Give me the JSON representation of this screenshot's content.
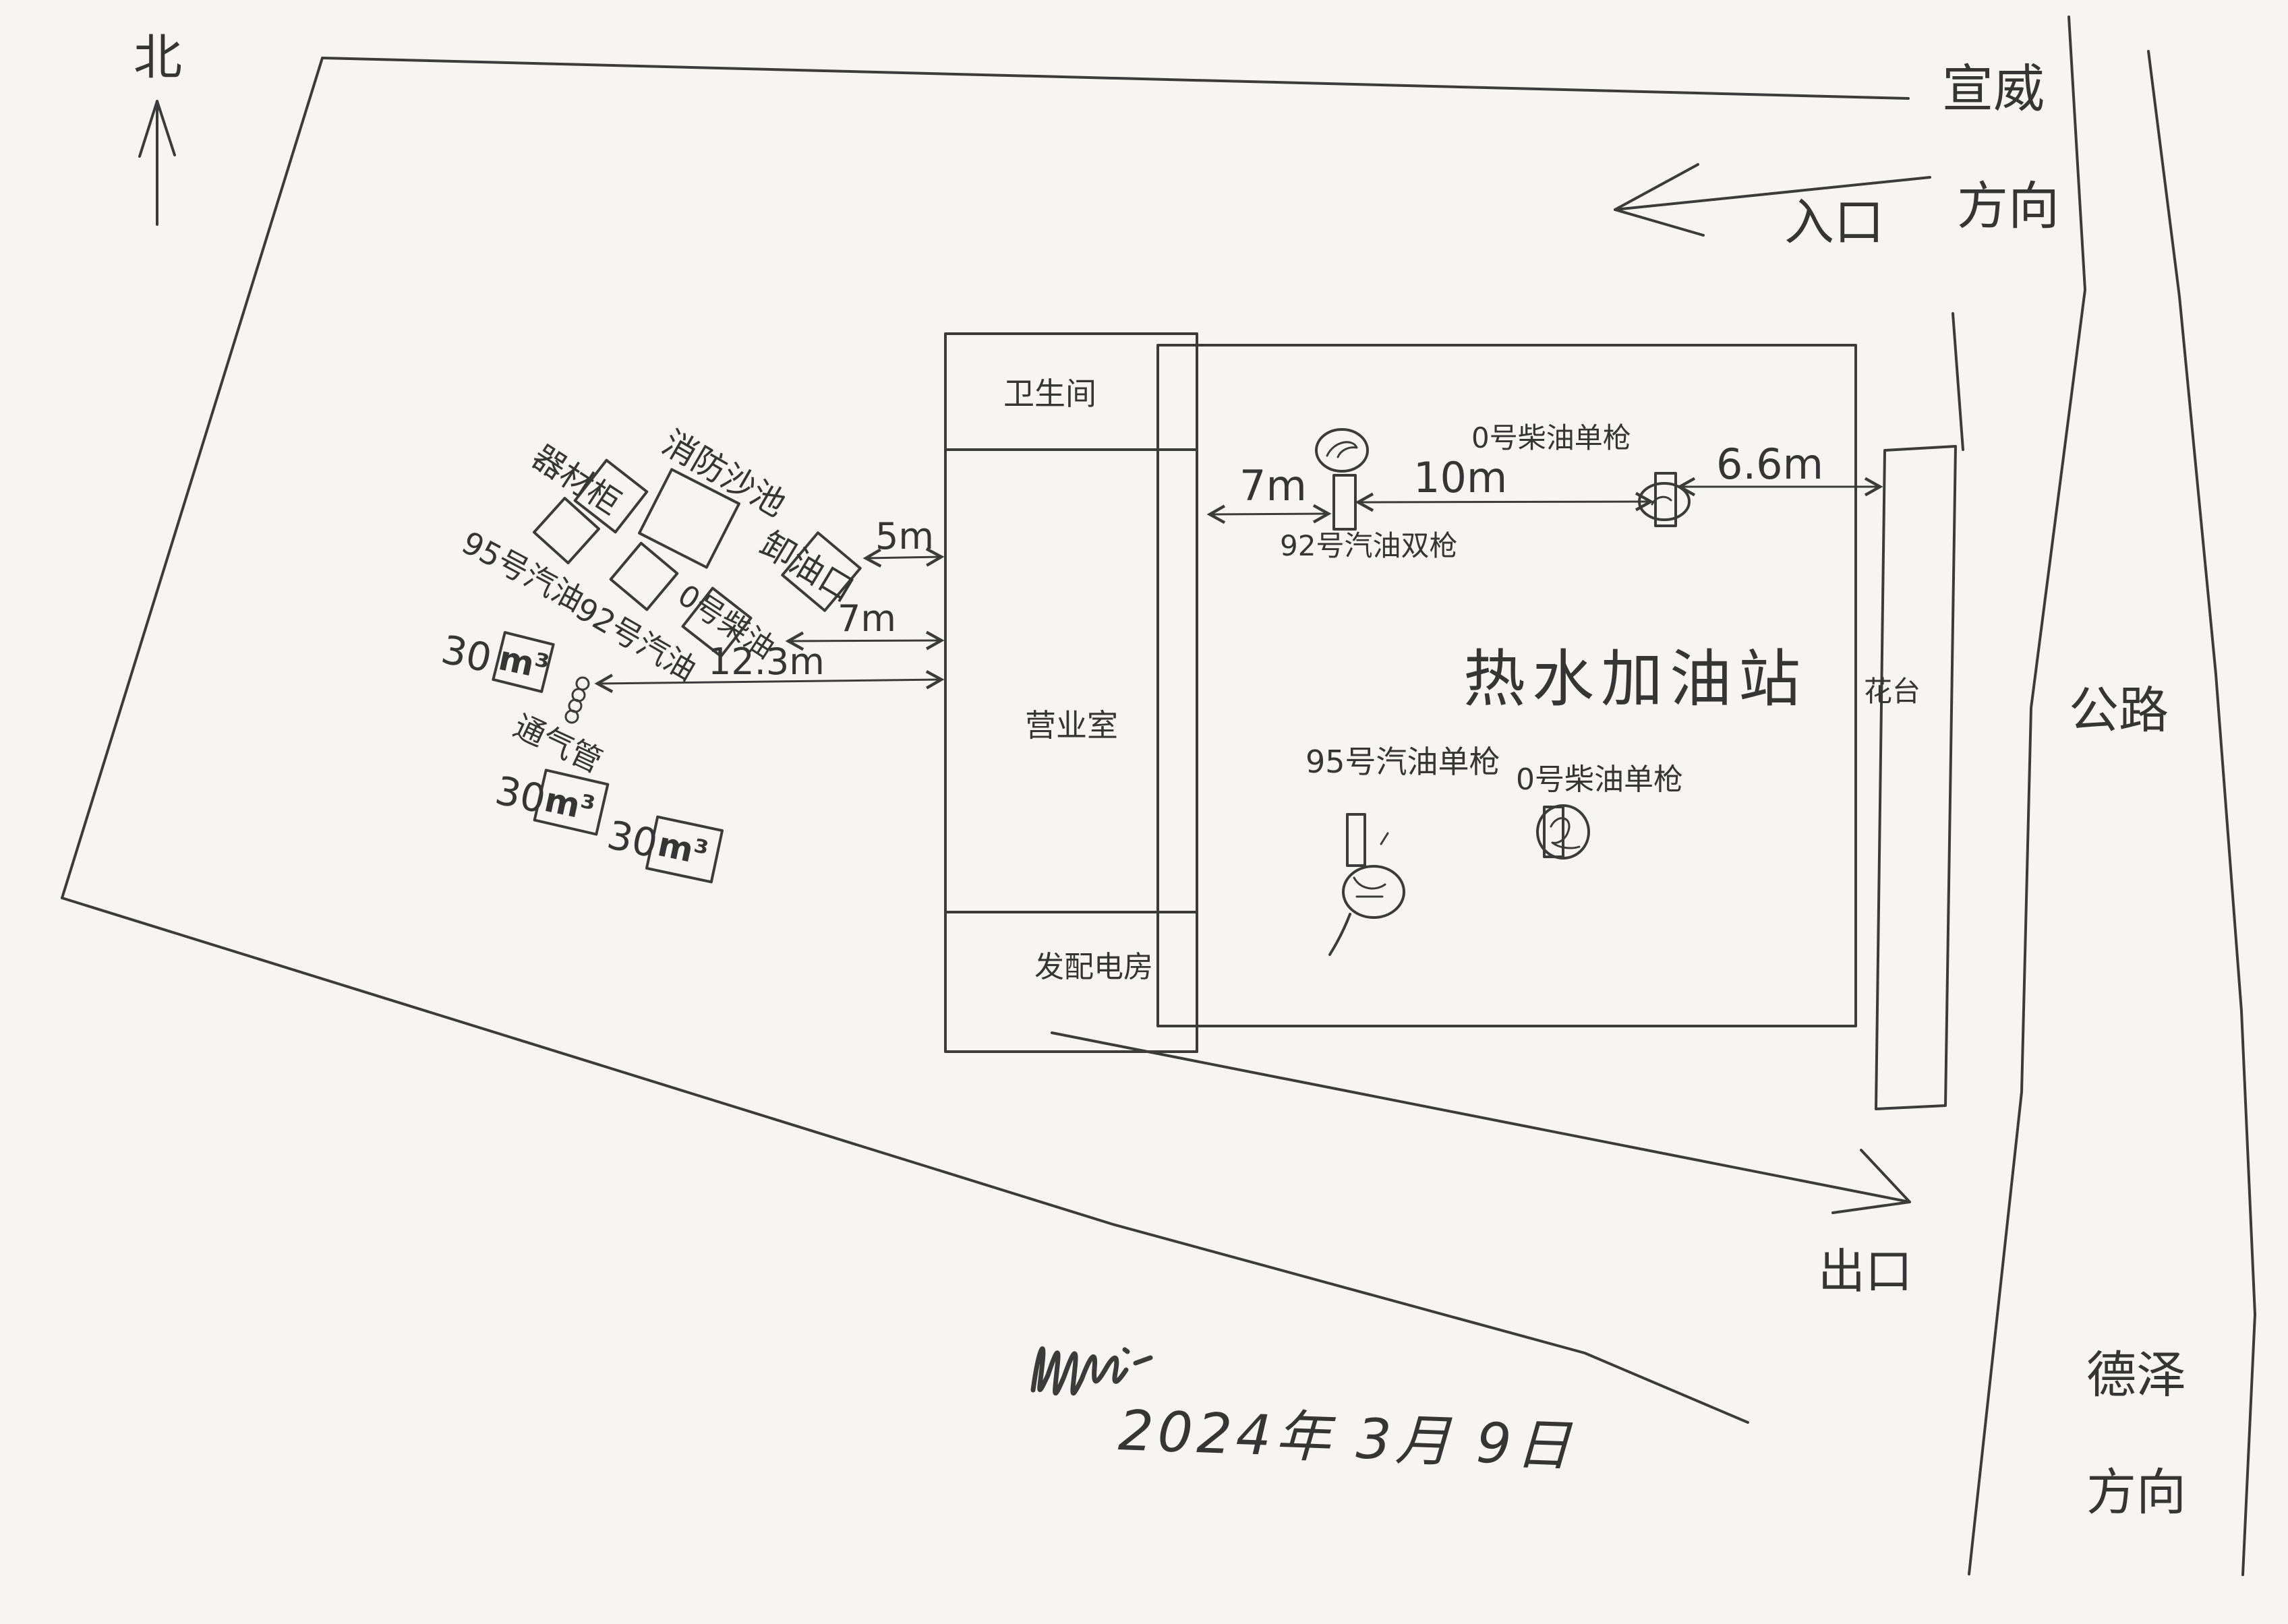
{
  "compass": {
    "north": "北"
  },
  "directions": {
    "xuanwei_top": "宣威",
    "xuanwei_bottom": "方向",
    "deze_top": "德泽",
    "deze_bottom": "方向",
    "entrance": "入口",
    "exit": "出口",
    "road": "公路"
  },
  "building": {
    "restroom": "卫生间",
    "office": "营业室",
    "power_room": "发配电房"
  },
  "station": {
    "canopy_title": "热水加油站",
    "flower_bed": "花台"
  },
  "dispensers": {
    "gas92_double": "92号汽油双枪",
    "diesel0_single_top": "0号柴油单枪",
    "gas95_single": "95号汽油单枪",
    "diesel0_single_bottom": "0号柴油单枪"
  },
  "tank_farm": {
    "equipment_cabinet": "器材柜",
    "fire_sand_pool": "消防沙池",
    "gas95_tank": "95号汽油",
    "gas92_tank": "92号汽油",
    "diesel0_tank": "0号柴油",
    "unloading_port": "卸油口",
    "vent_pipe": "通气管",
    "tank_volume": "30",
    "tank_volume_unit": "m³"
  },
  "dimensions": {
    "left_5m": "5m",
    "left_7m": "7m",
    "left_12_3m": "12.3m",
    "canopy_7m": "7m",
    "canopy_10m": "10m",
    "canopy_6_6m": "6.6m"
  },
  "footer": {
    "date": "2024年 3月 9日"
  },
  "colors": {
    "ink": "#3b3b3b",
    "paper": "#f6f5f1"
  }
}
